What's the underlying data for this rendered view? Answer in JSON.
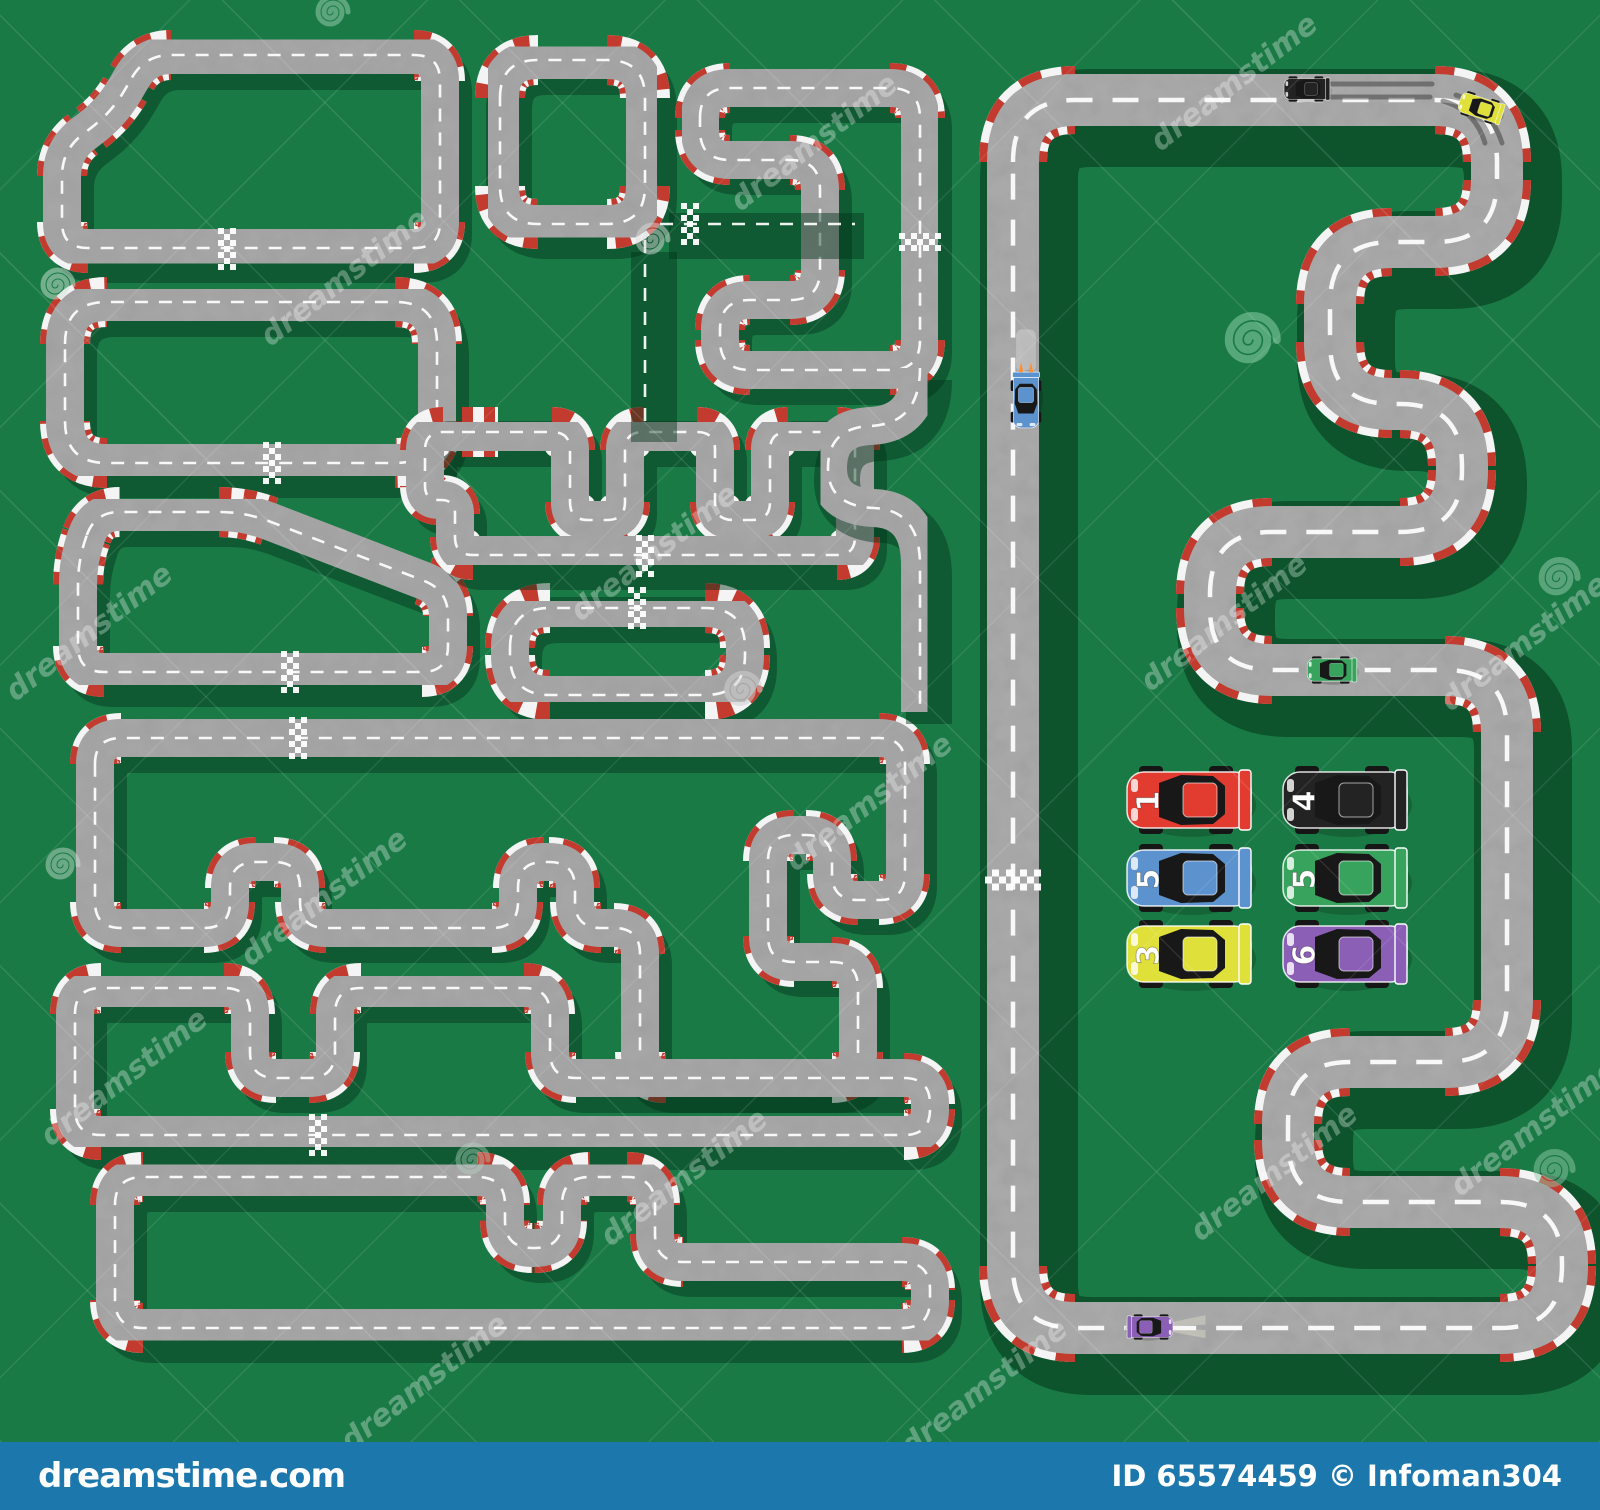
{
  "image": {
    "width": 1600,
    "height": 1510,
    "title": "Race tracks from top view with sport cars"
  },
  "colors": {
    "background": "#1a7a45",
    "shadow": "rgba(3,52,26,0.45)",
    "big_shadow": "rgba(3,52,26,0.55)",
    "road_small": "#a6a6a6",
    "road_big": "#a9a9a9",
    "curb_white": "#f4f4f4",
    "curb_red": "#c23b2e",
    "center_line": "#ffffff",
    "checker_white": "#ffffff",
    "skid": "#3a3a3a",
    "footer_bg": "#1c77ad"
  },
  "footer": {
    "brand": "dreamstime.com",
    "credit": "ID 65574459 © Infoman304"
  },
  "watermark": {
    "text": "dreamstime",
    "text_rotation": -38,
    "text_opacity": 0.3,
    "text_size": 30,
    "text_positions": [
      [
        350,
        285
      ],
      [
        820,
        150
      ],
      [
        1240,
        90
      ],
      [
        95,
        640
      ],
      [
        660,
        560
      ],
      [
        1230,
        630
      ],
      [
        1530,
        650
      ],
      [
        330,
        905
      ],
      [
        875,
        810
      ],
      [
        130,
        1085
      ],
      [
        690,
        1185
      ],
      [
        1280,
        1180
      ],
      [
        1540,
        1135
      ],
      [
        430,
        1390
      ],
      [
        990,
        1395
      ]
    ],
    "spirals": [
      {
        "x": 55,
        "y": 285,
        "s": 1.0,
        "c": "#cfe3d8",
        "o": 0.5
      },
      {
        "x": 650,
        "y": 240,
        "s": 1.0,
        "c": "#d9d9d9",
        "o": 0.5
      },
      {
        "x": 330,
        "y": 12,
        "s": 1.0,
        "c": "#9fd0b5",
        "o": 0.5
      },
      {
        "x": 740,
        "y": 690,
        "s": 1.1,
        "c": "#cfcfcf",
        "o": 0.55
      },
      {
        "x": 1248,
        "y": 340,
        "s": 1.6,
        "c": "#7fc49e",
        "o": 0.6
      },
      {
        "x": 1556,
        "y": 578,
        "s": 1.2,
        "c": "#8fc7a8",
        "o": 0.55
      },
      {
        "x": 1551,
        "y": 1170,
        "s": 1.2,
        "c": "#8fc7a8",
        "o": 0.5
      },
      {
        "x": 60,
        "y": 865,
        "s": 1.0,
        "c": "#cfe3d8",
        "o": 0.45
      },
      {
        "x": 470,
        "y": 1160,
        "s": 1.0,
        "c": "#bcd8c8",
        "o": 0.4
      }
    ]
  },
  "tracks": {
    "road_width_small": 38,
    "curb_width_small": 50,
    "road_width_big": 52,
    "curb_width_big": 68,
    "small": [
      {
        "name": "track-loop-1",
        "r": 26,
        "pts": [
          [
            145,
            55
          ],
          [
            440,
            55
          ],
          [
            440,
            248
          ],
          [
            62,
            248
          ],
          [
            62,
            150
          ],
          [
            112,
            112
          ]
        ]
      },
      {
        "name": "track-loop-2",
        "r": 38,
        "pts": [
          [
            500,
            60
          ],
          [
            645,
            60
          ],
          [
            645,
            224
          ],
          [
            500,
            224
          ]
        ]
      },
      {
        "name": "track-loop-3",
        "r": 30,
        "pts": [
          [
            700,
            88
          ],
          [
            920,
            88
          ],
          [
            920,
            370
          ],
          [
            720,
            370
          ],
          [
            720,
            300
          ],
          [
            820,
            300
          ],
          [
            820,
            160
          ],
          [
            700,
            160
          ]
        ]
      },
      {
        "name": "track-loop-4",
        "r": 42,
        "pts": [
          [
            65,
            302
          ],
          [
            437,
            302
          ],
          [
            437,
            463
          ],
          [
            65,
            463
          ]
        ]
      },
      {
        "name": "track-loop-5",
        "r": 26,
        "pts": [
          [
            95,
            512
          ],
          [
            245,
            512
          ],
          [
            448,
            590
          ],
          [
            448,
            672
          ],
          [
            78,
            672
          ],
          [
            78,
            560
          ]
        ]
      },
      {
        "name": "track-loop-6",
        "r": 40,
        "pts": [
          [
            510,
            608
          ],
          [
            745,
            608
          ],
          [
            745,
            695
          ],
          [
            510,
            695
          ]
        ]
      },
      {
        "name": "track-loop-7",
        "r": 18,
        "pts": [
          [
            480,
            432
          ],
          [
            570,
            432
          ],
          [
            570,
            520
          ],
          [
            625,
            520
          ],
          [
            625,
            432
          ],
          [
            715,
            432
          ],
          [
            715,
            520
          ],
          [
            770,
            520
          ],
          [
            770,
            432
          ],
          [
            855,
            432
          ],
          [
            855,
            555
          ],
          [
            455,
            555
          ],
          [
            455,
            500
          ],
          [
            425,
            500
          ],
          [
            425,
            432
          ]
        ]
      },
      {
        "name": "track-loop-8",
        "r": 26,
        "pts": [
          [
            95,
            738
          ],
          [
            905,
            738
          ],
          [
            905,
            900
          ],
          [
            832,
            900
          ],
          [
            832,
            835
          ],
          [
            768,
            835
          ],
          [
            768,
            962
          ],
          [
            858,
            962
          ],
          [
            858,
            1078
          ],
          [
            640,
            1078
          ],
          [
            640,
            928
          ],
          [
            575,
            928
          ],
          [
            575,
            862
          ],
          [
            518,
            862
          ],
          [
            518,
            928
          ],
          [
            300,
            928
          ],
          [
            300,
            862
          ],
          [
            230,
            862
          ],
          [
            230,
            928
          ],
          [
            95,
            928
          ]
        ]
      },
      {
        "name": "track-loop-9",
        "r": 26,
        "pts": [
          [
            75,
            988
          ],
          [
            250,
            988
          ],
          [
            250,
            1078
          ],
          [
            335,
            1078
          ],
          [
            335,
            988
          ],
          [
            550,
            988
          ],
          [
            550,
            1078
          ],
          [
            930,
            1078
          ],
          [
            930,
            1135
          ],
          [
            75,
            1135
          ]
        ]
      },
      {
        "name": "track-loop-10",
        "r": 28,
        "pts": [
          [
            115,
            1177
          ],
          [
            505,
            1177
          ],
          [
            505,
            1248
          ],
          [
            562,
            1248
          ],
          [
            562,
            1177
          ],
          [
            655,
            1177
          ],
          [
            655,
            1262
          ],
          [
            930,
            1262
          ],
          [
            930,
            1328
          ],
          [
            115,
            1328
          ]
        ]
      }
    ],
    "extras": [
      {
        "name": "track-link-1",
        "d": "M 645,240 V 430"
      },
      {
        "name": "track-link-2",
        "d": "M 660,224 H 855"
      },
      {
        "name": "track-link-3",
        "d": "M 920,368 Q 920,424 870,426 Q 828,428 828,468 Q 828,506 874,508 Q 920,510 920,565 V 712"
      }
    ],
    "big": {
      "name": "track-grand-circuit",
      "r": 62,
      "pts": [
        [
          1013,
          100
        ],
        [
          1497,
          100
        ],
        [
          1497,
          242
        ],
        [
          1330,
          242
        ],
        [
          1330,
          404
        ],
        [
          1462,
          404
        ],
        [
          1462,
          532
        ],
        [
          1210,
          532
        ],
        [
          1210,
          670
        ],
        [
          1507,
          670
        ],
        [
          1507,
          1062
        ],
        [
          1288,
          1062
        ],
        [
          1288,
          1202
        ],
        [
          1562,
          1202
        ],
        [
          1562,
          1328
        ],
        [
          1013,
          1328
        ]
      ]
    }
  },
  "checkers": [
    {
      "x": 227,
      "y": 249,
      "angle": 0,
      "big": false
    },
    {
      "x": 272,
      "y": 463,
      "angle": 0,
      "big": false
    },
    {
      "x": 690,
      "y": 224,
      "angle": 0,
      "big": false
    },
    {
      "x": 637,
      "y": 608,
      "angle": 0,
      "big": false
    },
    {
      "x": 645,
      "y": 556,
      "angle": 0,
      "big": false
    },
    {
      "x": 298,
      "y": 738,
      "angle": 0,
      "big": false
    },
    {
      "x": 318,
      "y": 1135,
      "angle": 0,
      "big": false
    },
    {
      "x": 290,
      "y": 672,
      "angle": 0,
      "big": false
    },
    {
      "x": 920,
      "y": 242,
      "angle": 90,
      "big": false
    },
    {
      "x": 1013,
      "y": 880,
      "angle": 90,
      "big": true
    }
  ],
  "skid_marks": [
    {
      "d": "M 1318,84 H 1432"
    },
    {
      "d": "M 1318,97 H 1430"
    },
    {
      "d": "M 1443,101 q 32,9 42,42"
    },
    {
      "d": "M 1456,95 q 34,11 46,48"
    }
  ],
  "cars": [
    {
      "name": "race-car-red-1",
      "color": "#e23b30",
      "num": "1",
      "x": 1189,
      "y": 800,
      "rot": 0,
      "scale": 1,
      "flip": false
    },
    {
      "name": "race-car-black-4",
      "color": "#232323",
      "num": "4",
      "x": 1345,
      "y": 800,
      "rot": 0,
      "scale": 1,
      "flip": false
    },
    {
      "name": "race-car-blue-5",
      "color": "#5c93cf",
      "num": "5",
      "x": 1189,
      "y": 878,
      "rot": 0,
      "scale": 1,
      "flip": false
    },
    {
      "name": "race-car-green-5",
      "color": "#37a35d",
      "num": "5",
      "x": 1345,
      "y": 878,
      "rot": 0,
      "scale": 1,
      "flip": false
    },
    {
      "name": "race-car-yellow-3",
      "color": "#e0e03a",
      "num": "3",
      "x": 1189,
      "y": 954,
      "rot": 0,
      "scale": 1,
      "flip": false
    },
    {
      "name": "race-car-purple-6",
      "color": "#8a5fb5",
      "num": "6",
      "x": 1345,
      "y": 954,
      "rot": 0,
      "scale": 1,
      "flip": false
    },
    {
      "name": "race-car-track-black",
      "color": "#232323",
      "num": "",
      "x": 1307,
      "y": 89,
      "rot": 0,
      "scale": 0.37,
      "flip": false
    },
    {
      "name": "race-car-track-yellow",
      "color": "#e0e03a",
      "num": "",
      "x": 1481,
      "y": 108,
      "rot": 18,
      "scale": 0.36,
      "flip": false
    },
    {
      "name": "race-car-track-blue",
      "color": "#5c93cf",
      "num": "",
      "x": 1026,
      "y": 400,
      "rot": -90,
      "scale": 0.45,
      "flip": false,
      "flames": true,
      "streak": true
    },
    {
      "name": "race-car-track-green",
      "color": "#37a35d",
      "num": "",
      "x": 1332,
      "y": 670,
      "rot": 0,
      "scale": 0.4,
      "flip": false
    },
    {
      "name": "race-car-track-purple",
      "color": "#8a5fb5",
      "num": "",
      "x": 1150,
      "y": 1327,
      "rot": 0,
      "scale": 0.37,
      "flip": true,
      "beams": true
    }
  ]
}
